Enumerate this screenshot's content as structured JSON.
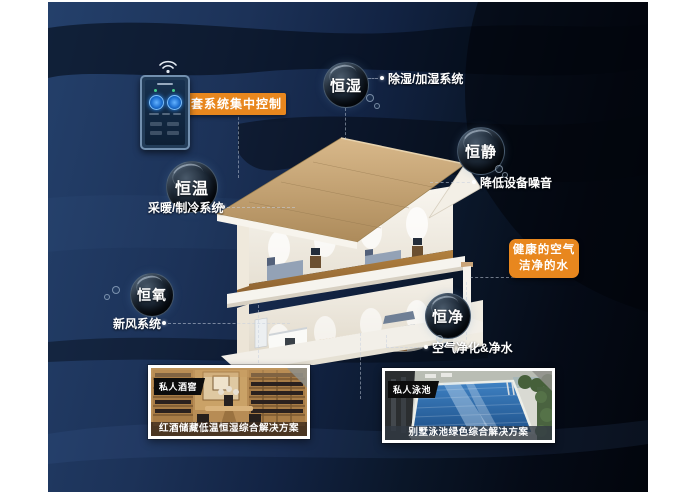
{
  "control": {
    "label": "一套系统集中控制"
  },
  "icons": {
    "wifi": "wifi-icon"
  },
  "bubbles": [
    {
      "id": "heng-shi",
      "label": "恒湿",
      "desc": "除湿/加湿系统"
    },
    {
      "id": "heng-jing",
      "label": "恒静",
      "desc": "降低设备噪音"
    },
    {
      "id": "heng-wen",
      "label": "恒温",
      "desc": "采暖/制冷系统"
    },
    {
      "id": "heng-yang",
      "label": "恒氧",
      "desc": "新风系统"
    },
    {
      "id": "heng-jing2",
      "label": "恒净",
      "desc": "空气净化&净水"
    }
  ],
  "badge": {
    "line1": "健康的空气",
    "line2": "洁净的水"
  },
  "cards": [
    {
      "tag": "私人酒窖",
      "caption": "红酒储藏低温恒湿综合解决方案"
    },
    {
      "tag": "私人泳池",
      "caption": "别墅泳池绿色综合解决方案"
    }
  ],
  "colors": {
    "accent_orange": "#E8871E",
    "bg_navy": "#1C3258",
    "bg_dark": "#02050C",
    "pool_blue": "#2F74B5",
    "cellar_wood": "#B78C55"
  }
}
